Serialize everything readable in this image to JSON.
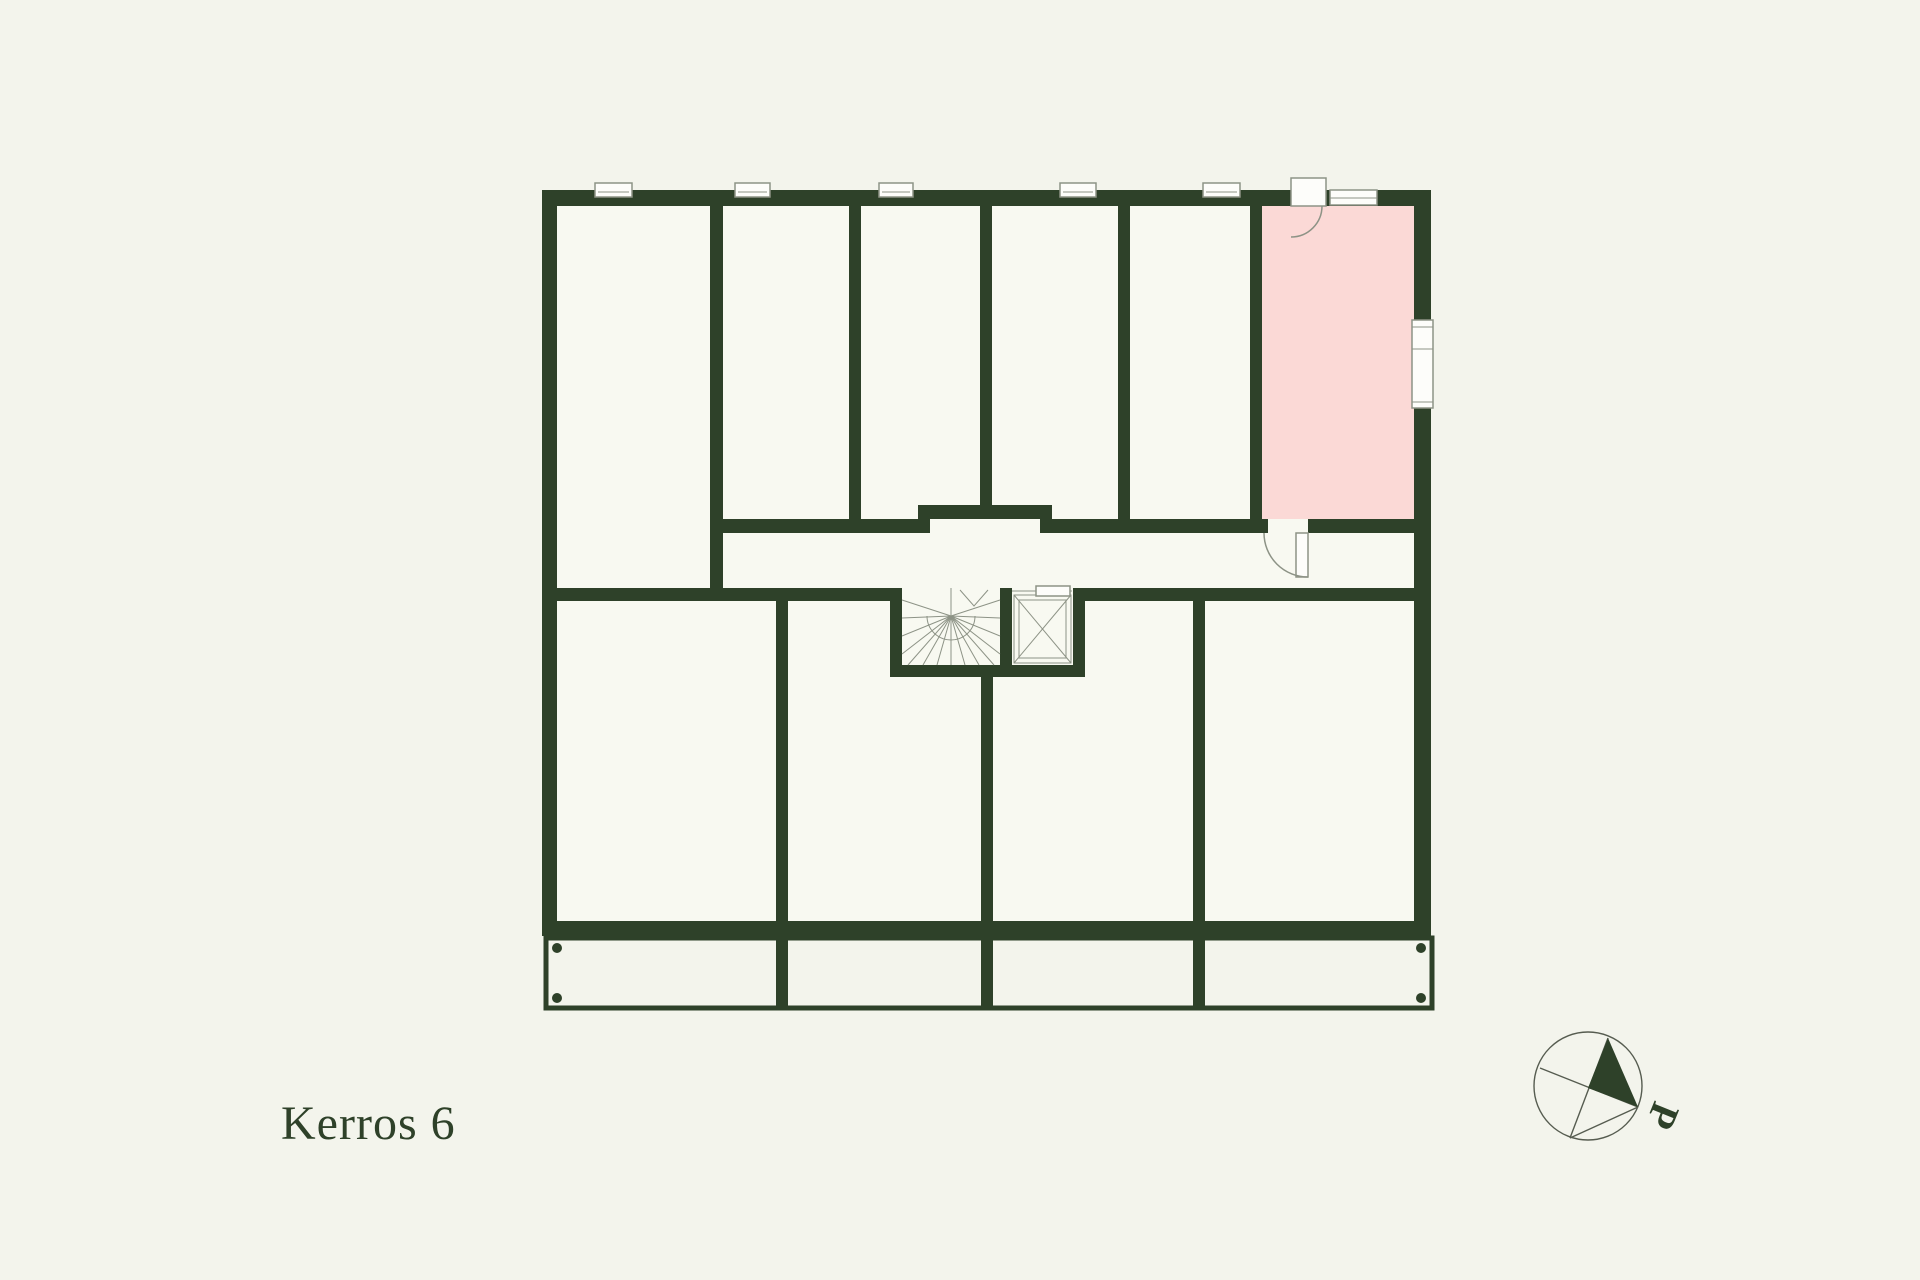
{
  "floor_label": "Kerros 6",
  "compass": {
    "label": "P"
  },
  "colors": {
    "background": "#f3f4ec",
    "room": "#f8f9f1",
    "wall": "#2e4129",
    "highlight": "#fbd9d6",
    "line": "#8d9386",
    "linedark": "#565c50",
    "text": "#2e4129",
    "white": "#fdfdfa"
  }
}
